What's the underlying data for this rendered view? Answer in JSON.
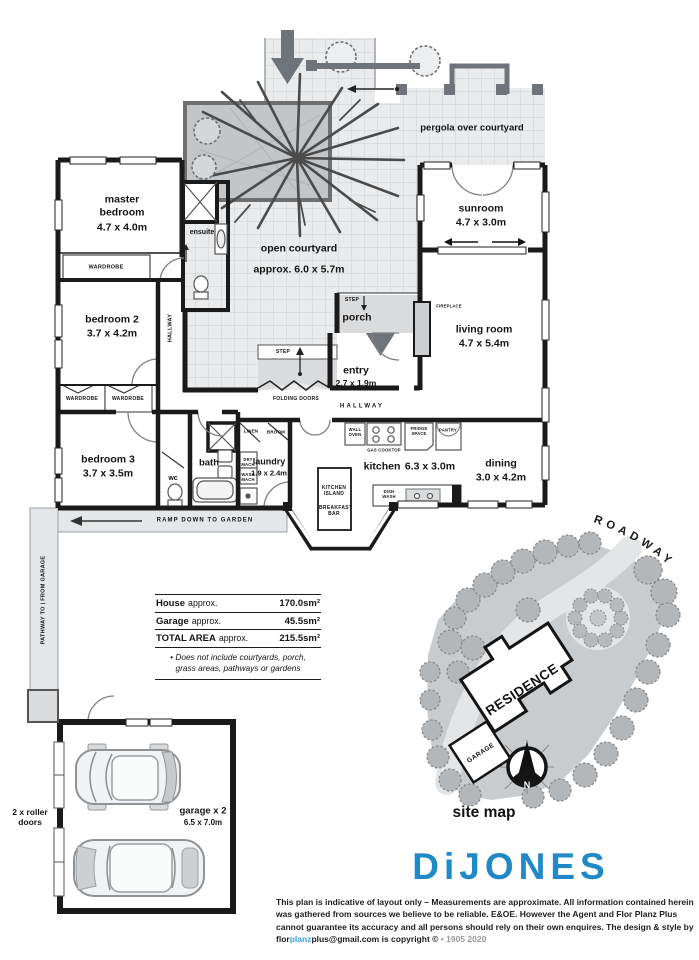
{
  "colors": {
    "accent_blue": "#2189c5",
    "link_blue": "#3f9fd4",
    "wall_black": "#1a1a1a",
    "tile_gray": "#e9ebec",
    "mid_gray": "#6e747a",
    "muted_gray": "#9a9a9a"
  },
  "rooms": {
    "master": {
      "name": "master bedroom",
      "dims": "4.7 x 4.0m"
    },
    "bedroom2": {
      "name": "bedroom 2",
      "dims": "3.7 x 4.2m"
    },
    "bedroom3": {
      "name": "bedroom 3",
      "dims": "3.7 x 3.5m"
    },
    "ensuite": {
      "name": "ensuite"
    },
    "wc": {
      "name": "wc"
    },
    "bath": {
      "name": "bath"
    },
    "laundry": {
      "name": "laundry",
      "dims": "1.9 x 2.4m"
    },
    "kitchen": {
      "name": "kitchen",
      "dims": "6.3 x 3.0m"
    },
    "dining": {
      "name": "dining",
      "dims": "3.0 x 4.2m"
    },
    "living": {
      "name": "living room",
      "dims": "4.7 x 5.4m"
    },
    "sunroom": {
      "name": "sunroom",
      "dims": "4.7 x 3.0m"
    },
    "porch": {
      "name": "porch"
    },
    "entry": {
      "name": "entry",
      "dims": "2.7 x 1.9m"
    },
    "courtyard": {
      "name": "open courtyard",
      "dims": "approx. 6.0 x 5.7m"
    },
    "pergola": {
      "name": "pergola over courtyard"
    },
    "garage": {
      "name": "garage x 2",
      "dims": "6.5 x 7.0m"
    }
  },
  "fixtures": {
    "wardrobe": "WARDROBE",
    "hallway": "HALLWAY",
    "step": "STEP",
    "folding_doors": "FOLDING DOORS",
    "linen": "LINEN",
    "broom": "BROOM",
    "dry_mach": "DRY MACH",
    "wash_mach": "WASH MACH",
    "wall_oven": "WALL OVEN",
    "gas_cooktop": "GAS COOKTOP",
    "fridge_space": "FRIDGE SPACE",
    "pantry": "PANTRY",
    "kitchen_island": "KITCHEN ISLAND",
    "breakfast_bar": "BREAKFAST BAR",
    "dish_wash": "DISH WASH",
    "fireplace": "FIREPLACE"
  },
  "annotations": {
    "ramp": "RAMP DOWN TO GARDEN",
    "pathway": "PATHWAY TO | FROM GARAGE",
    "roller_doors": "2 x roller doors"
  },
  "areas_table": {
    "rows": [
      {
        "name": "House",
        "qualifier": "approx.",
        "value": "170.0sm²"
      },
      {
        "name": "Garage",
        "qualifier": "approx.",
        "value": "45.5sm²"
      },
      {
        "name": "TOTAL AREA",
        "qualifier": "approx.",
        "value": "215.5sm²"
      }
    ],
    "note_line1": "• Does not include courtyards, porch,",
    "note_line2": "grass areas, pathways or gardens"
  },
  "site_map": {
    "roadway": "ROADWAY",
    "residence": "RESIDENCE",
    "garage": "GARAGE",
    "north": "N",
    "caption": "site map"
  },
  "branding": {
    "logo": "DiJONES"
  },
  "disclaimer": {
    "line1": "This plan is indicative of layout only  –  Measurements are approximate. All information contained herein was gathered",
    "line2": "from sources we believe to be reliable. E&OE. However the Agent and Flor Planz Plus cannot guarantee its accuracy and",
    "line3_a": "all persons should rely on their own enquires. The design & style by flor",
    "line3_b": "planz",
    "line3_c": "plus@gmail.com is copyright ©",
    "line3_d": "•  1905 2020"
  }
}
